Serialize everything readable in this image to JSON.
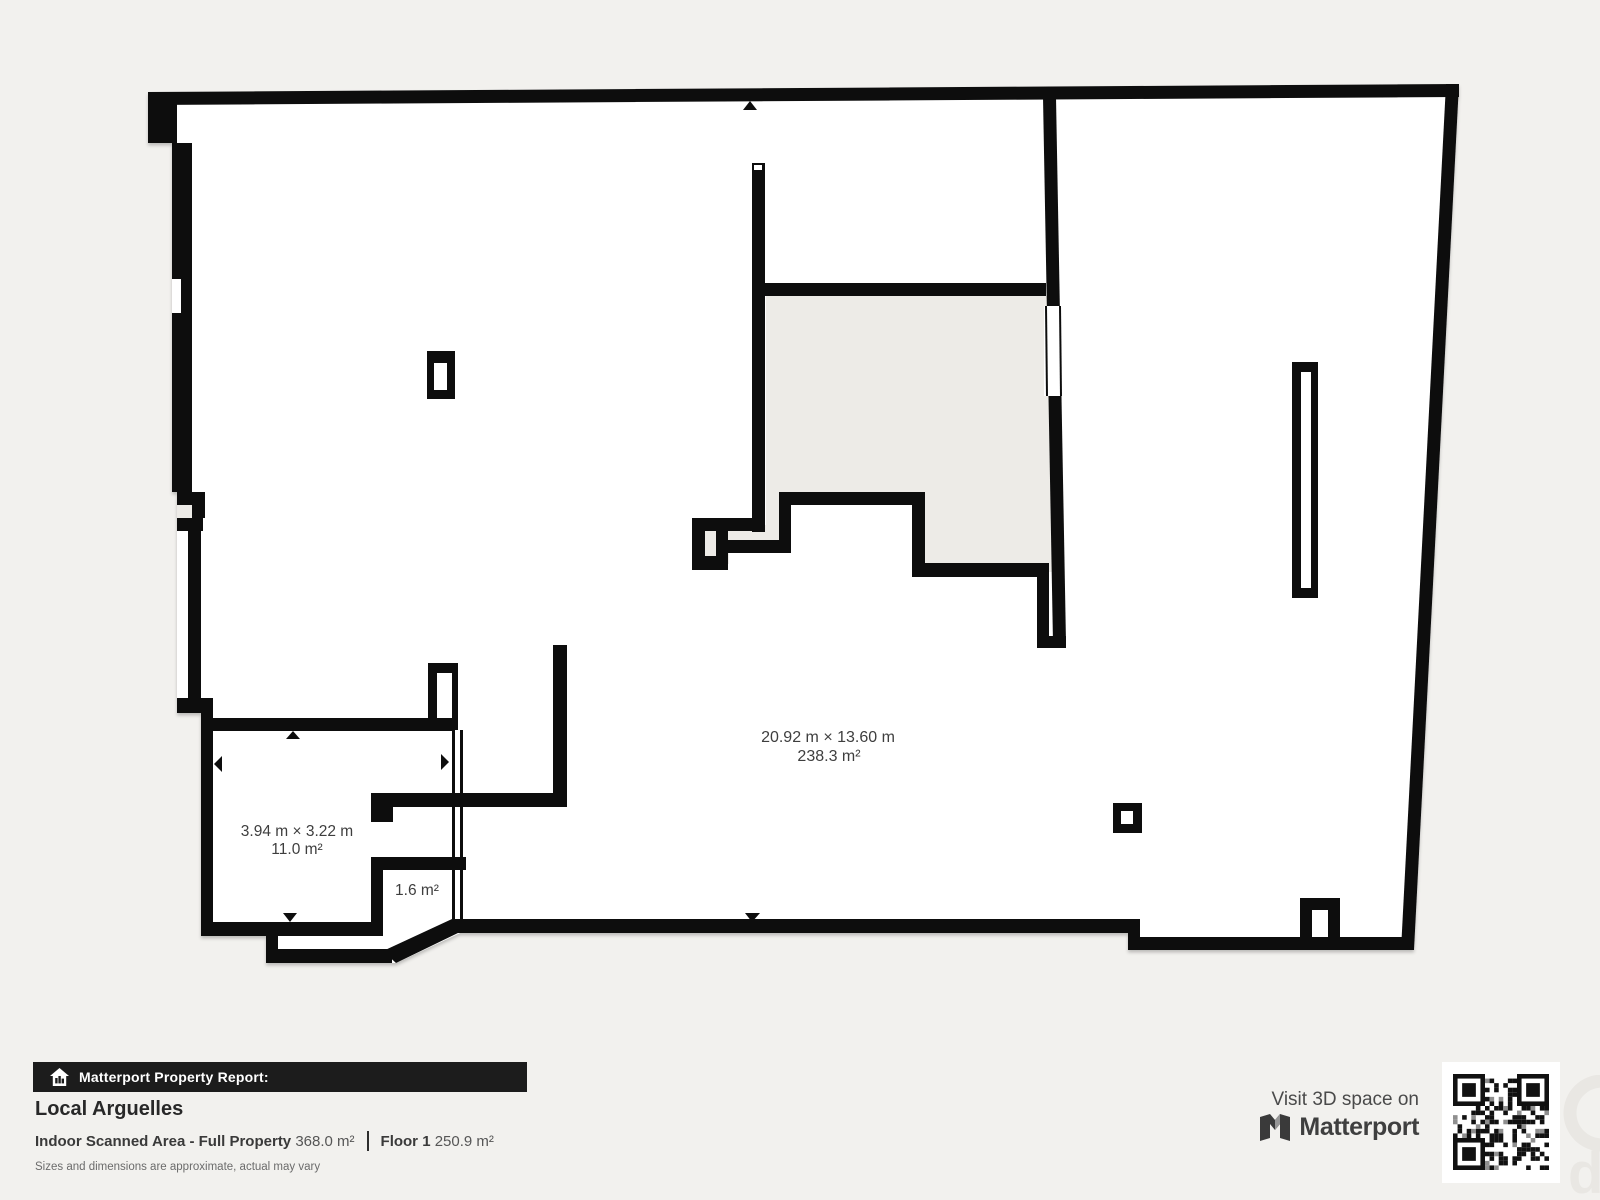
{
  "plan": {
    "rooms": [
      {
        "name": "main-room",
        "dims": "20.92 m × 13.60 m",
        "area": "238.3 m²"
      },
      {
        "name": "small-room",
        "dims": "3.94 m × 3.22 m",
        "area": "11.0 m²"
      },
      {
        "name": "vestibule",
        "area": "1.6 m²"
      }
    ]
  },
  "footer": {
    "report_label": "Matterport Property Report:",
    "property_name": "Local Arguelles",
    "scanned_area_label": "Indoor Scanned Area - Full Property",
    "scanned_area_value": "368.0 m²",
    "floor_label": "Floor 1",
    "floor_area_value": "250.9 m²",
    "disclaimer": "Sizes and dimensions are approximate, actual may vary"
  },
  "cta": {
    "visit_label": "Visit 3D space on",
    "brand": "Matterport"
  },
  "icons": [
    "house-icon",
    "matterport-logo-icon",
    "qr-code",
    "door-arrow-icons"
  ],
  "colors": {
    "wall": "#0f0f0f",
    "background": "#f2f1ee",
    "excluded_area": "#edebe7",
    "footer_bar": "#1c1c1c",
    "label_text": "#3e3e3e",
    "plan_floor": "#ffffff"
  }
}
